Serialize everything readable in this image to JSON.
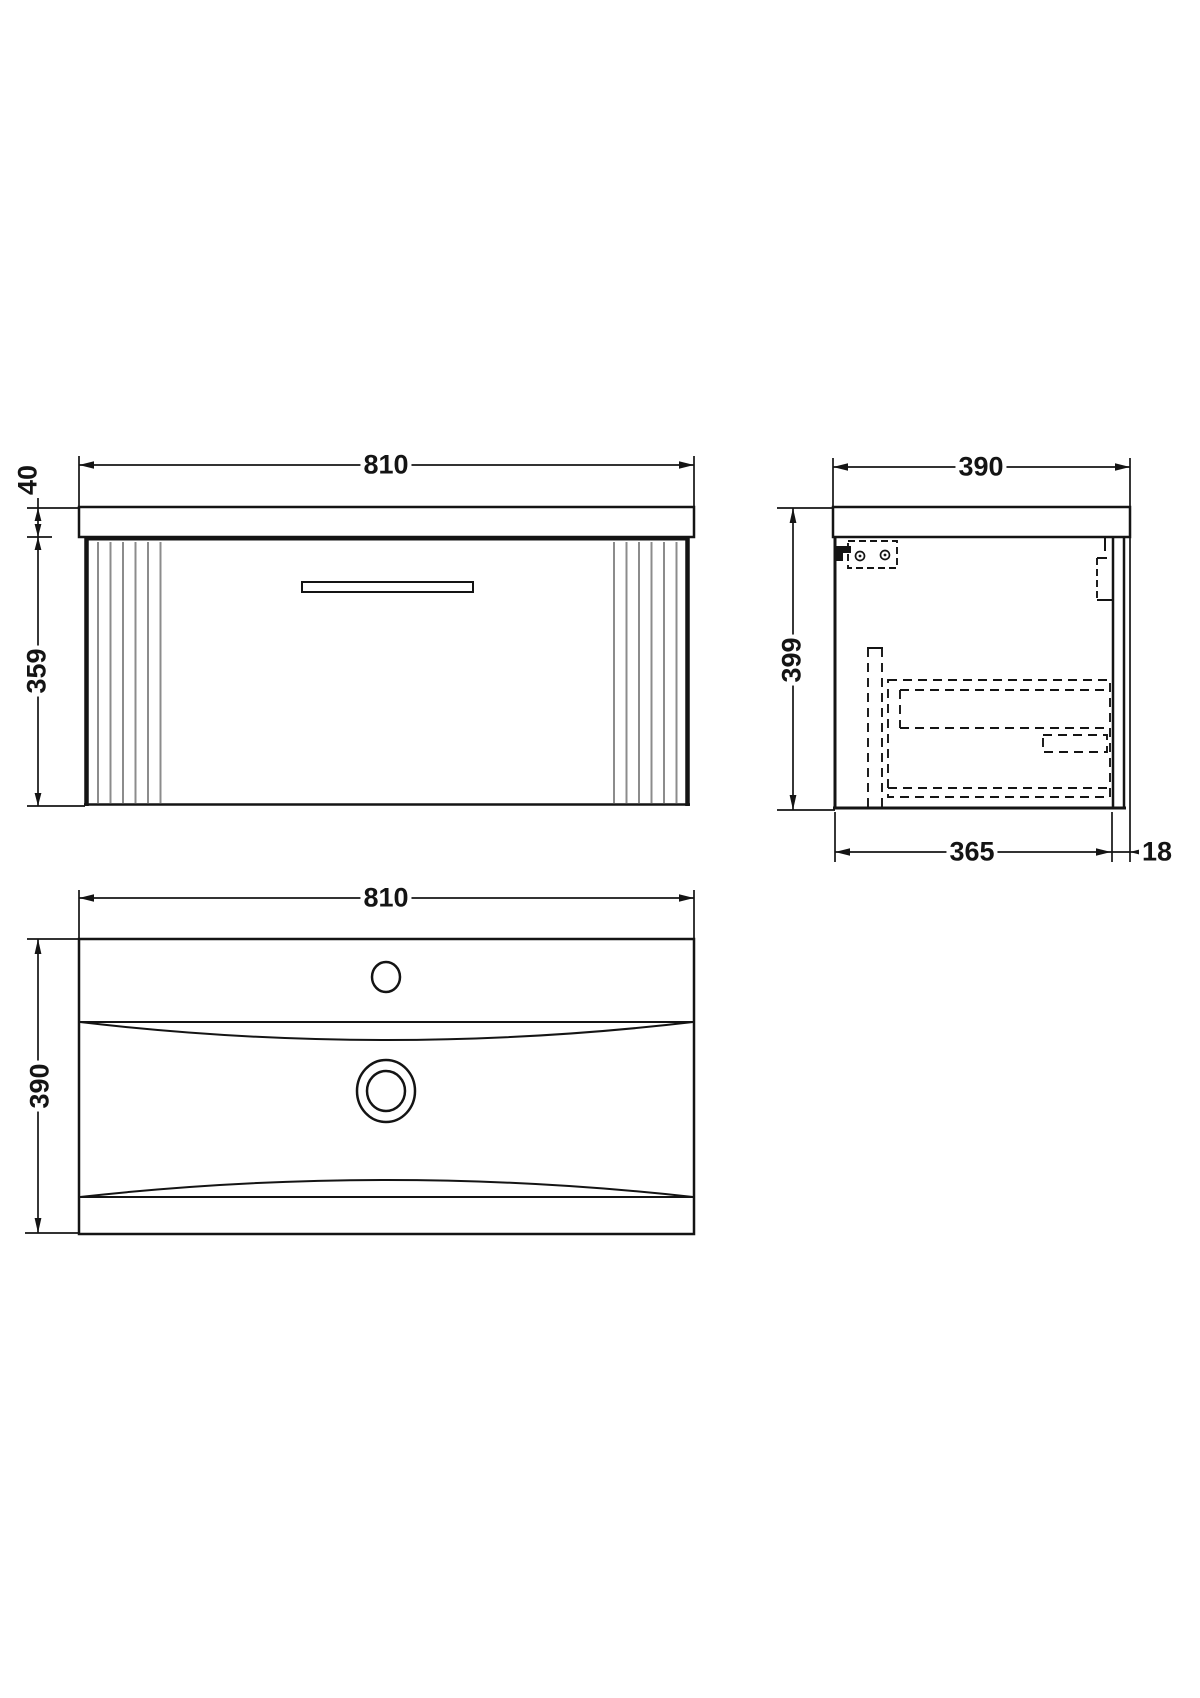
{
  "colors": {
    "line": "#141414",
    "flute_line": "#8c8c8c",
    "background": "#ffffff"
  },
  "views": {
    "front_elevation": {
      "dimensions": {
        "overall_width": "810",
        "worktop_thickness": "40",
        "cabinet_height": "359"
      }
    },
    "side_section": {
      "dimensions": {
        "overall_depth": "390",
        "overall_height": "399",
        "cabinet_depth": "365",
        "back_rail_offset": "18"
      }
    },
    "basin_plan": {
      "dimensions": {
        "basin_width": "810",
        "basin_depth": "390"
      }
    }
  }
}
